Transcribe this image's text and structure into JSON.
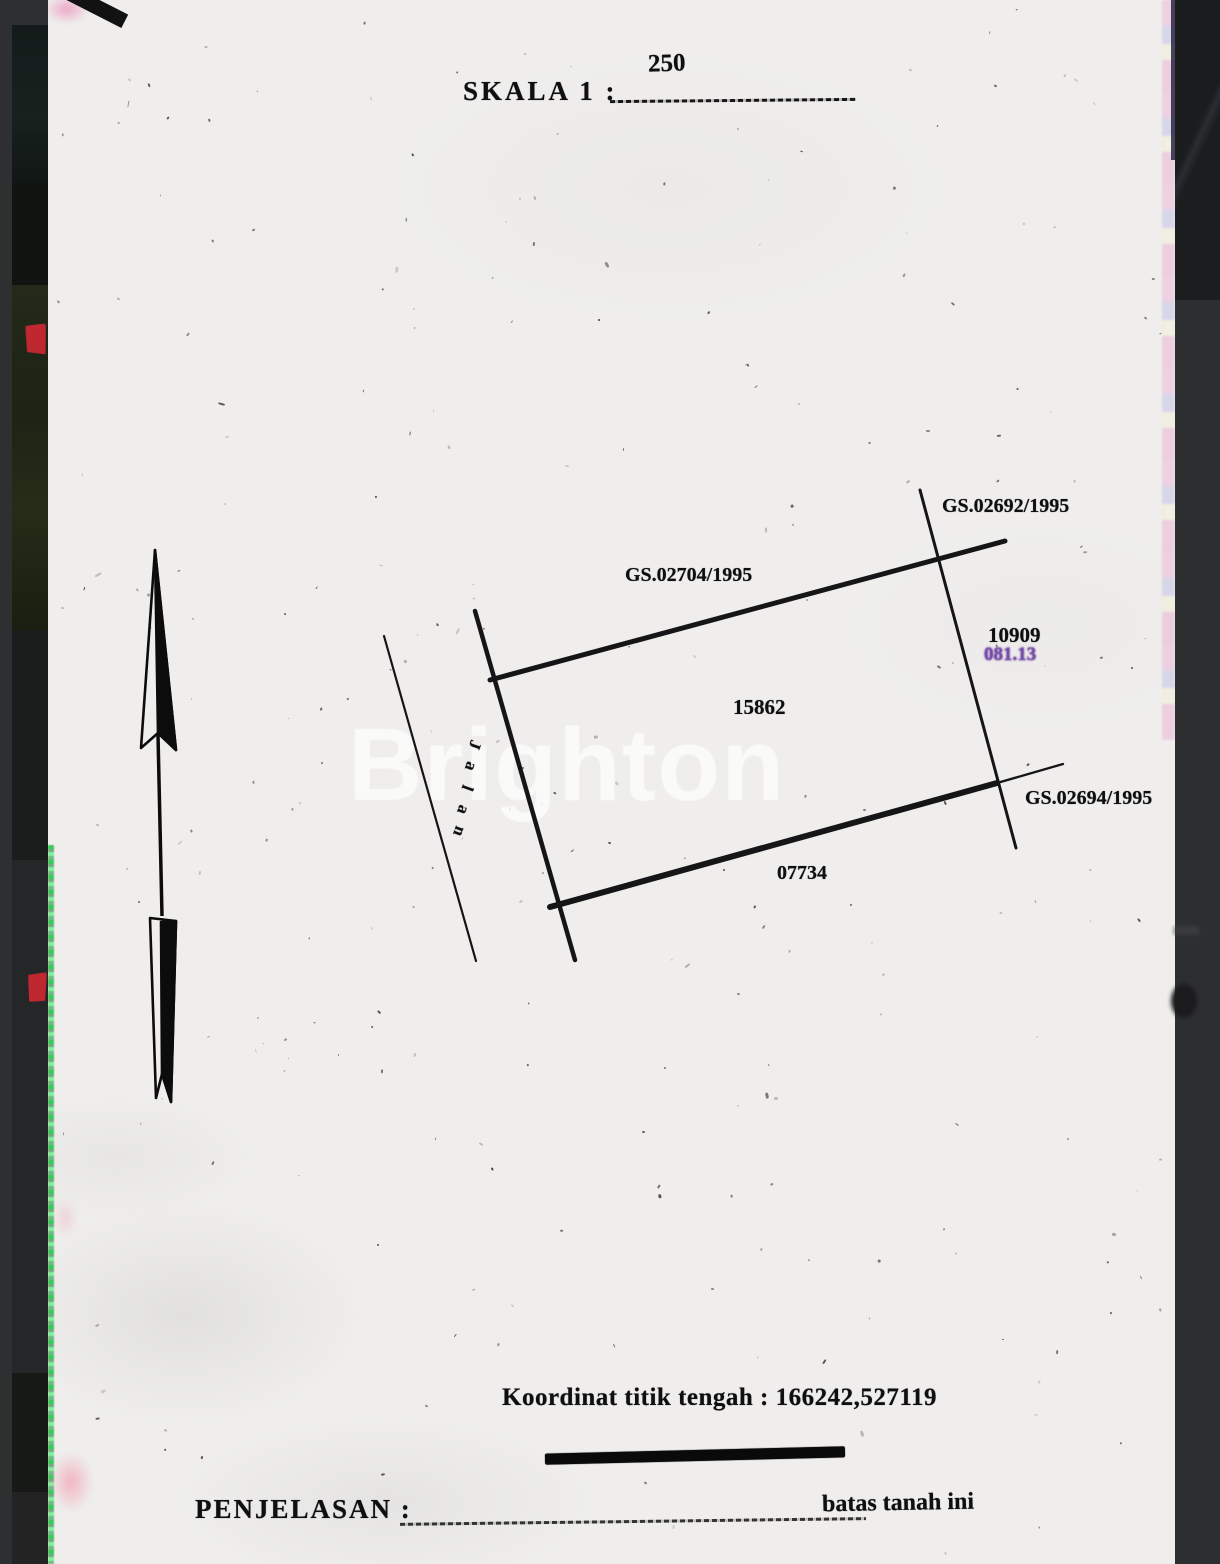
{
  "header": {
    "scale_label": "SKALA 1 :",
    "scale_value": "250"
  },
  "watermark": {
    "text": "Brighton"
  },
  "map": {
    "boundary_labels": {
      "north": "GS.02704/1995",
      "northeast": "GS.02692/1995",
      "southeast": "GS.02694/1995"
    },
    "parcel_numbers": {
      "center": "15862",
      "east_top": "10909",
      "east_bottom": "081.13",
      "south": "07734"
    },
    "road_label": "Jalan"
  },
  "footer": {
    "center_coordinate": "Koordinat titik tengah : 166242,527119",
    "legend_label": "PENJELASAN :",
    "legend_item": "batas tanah ini"
  },
  "colors": {
    "paper": "#efeeec",
    "ink": "#0f0f12",
    "accent_purple": "#6b4ba6",
    "legend_bar": "#0a0a0a"
  }
}
